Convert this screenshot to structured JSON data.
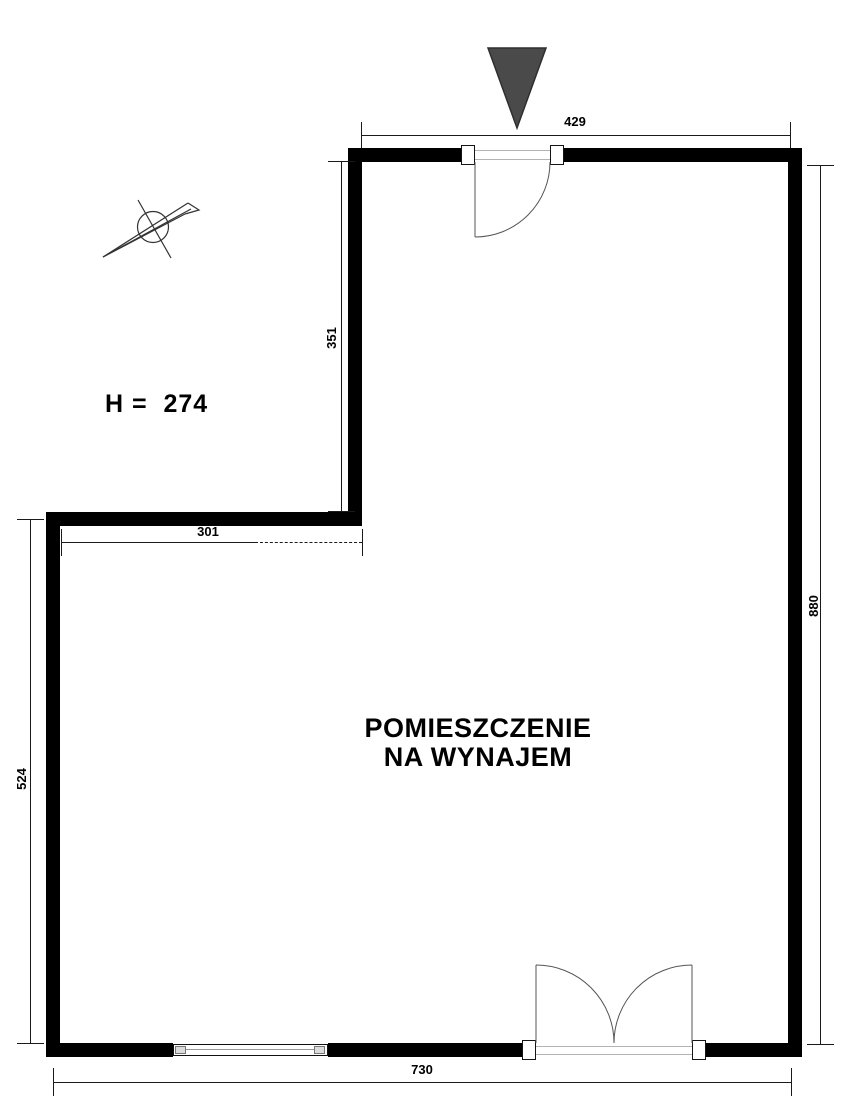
{
  "plan": {
    "room_label_line1": "POMIESZCZENIE",
    "room_label_line2": "NA WYNAJEM",
    "height_label": "H =  274",
    "dimensions": {
      "top_width": "429",
      "upper_wall_height": "351",
      "inner_width": "301",
      "left_height": "524",
      "right_height": "880",
      "bottom_width": "730"
    },
    "icons": {
      "north_arrow": "north-arrow-icon",
      "entrance_marker": "entrance-arrow-icon",
      "single_door": "door-swing-icon",
      "double_door": "double-door-swing-icon",
      "window": "window-symbol"
    },
    "colors": {
      "wall": "#000000",
      "line": "#1a1a1a",
      "entrance_marker": "#4a4a4a",
      "threshold": "#b3b3b3",
      "background": "#ffffff"
    }
  }
}
